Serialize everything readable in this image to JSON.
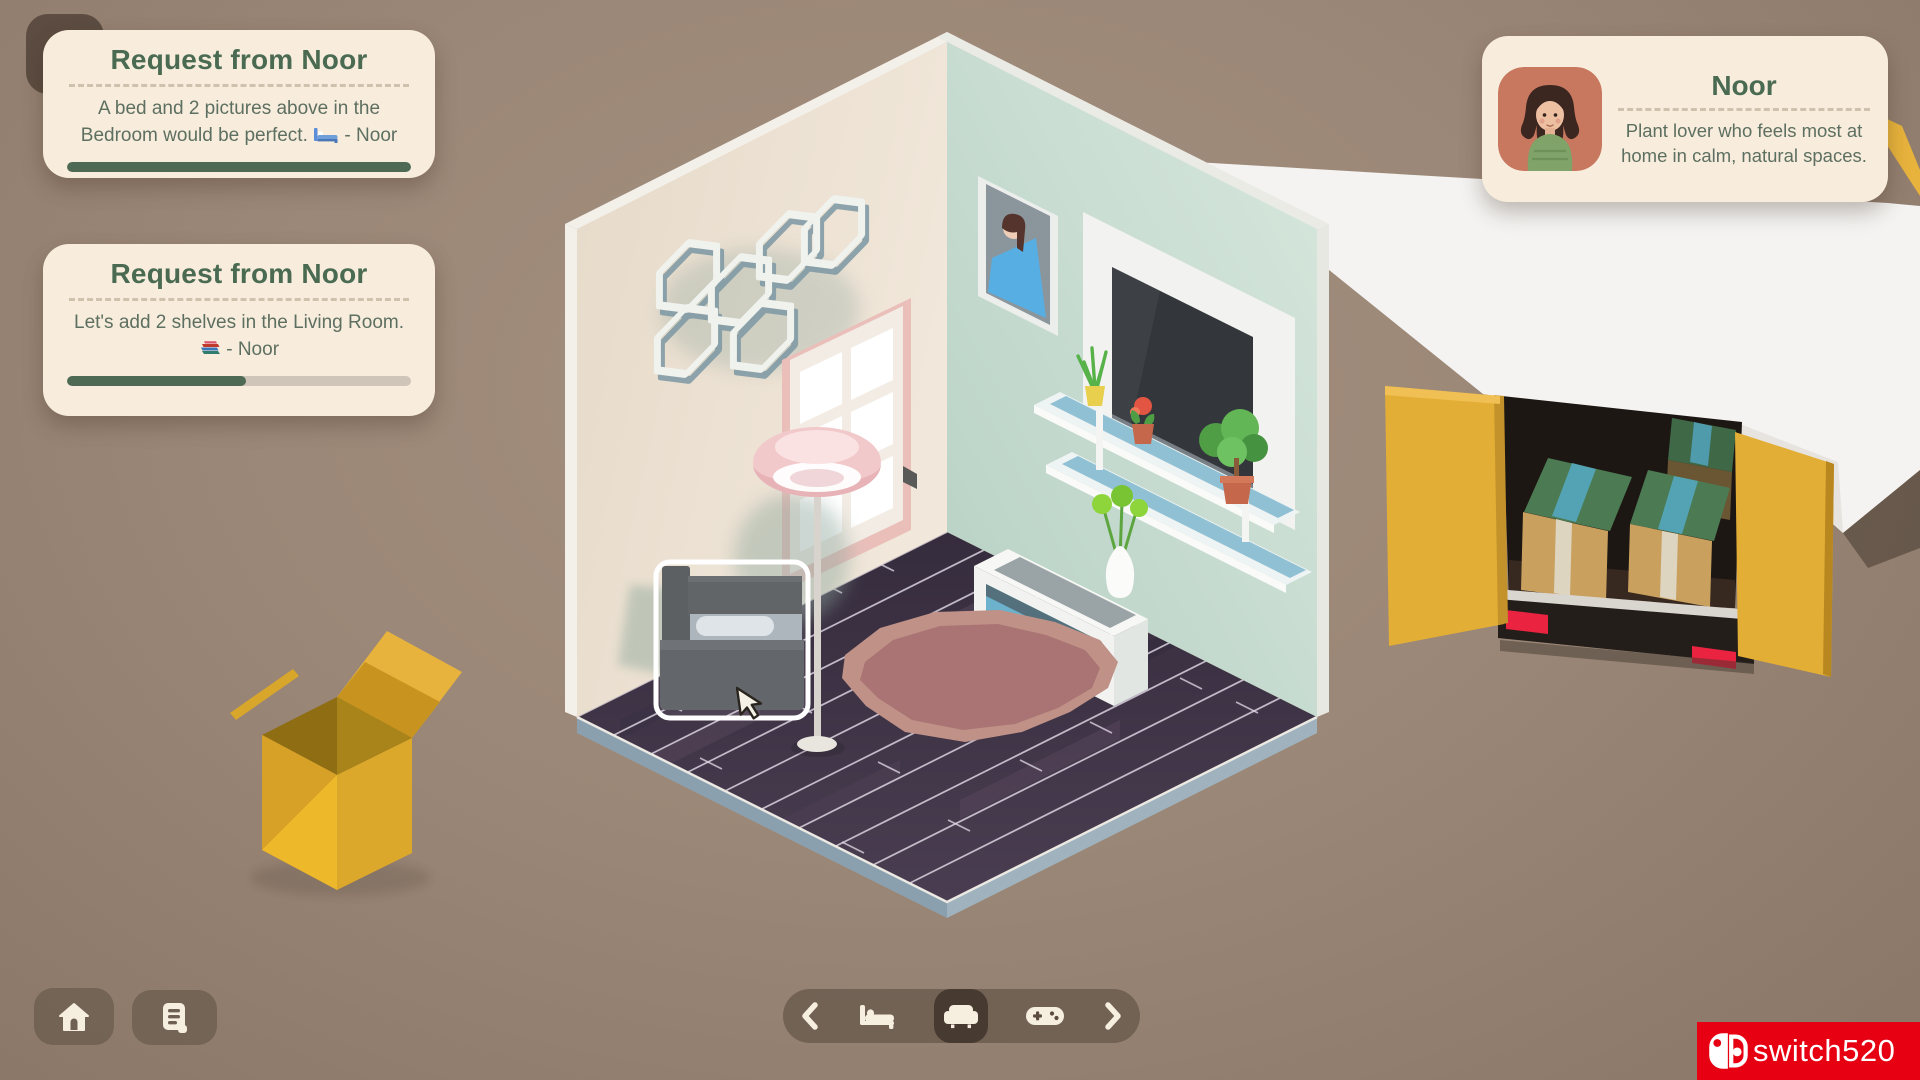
{
  "requests": [
    {
      "title": "Request from Noor",
      "body_main": "A bed and 2 pictures above in the Bedroom would be perfect.",
      "emoji_char": "🛏️",
      "emoji_name": "bed-emoji",
      "body_suffix": "- Noor",
      "progress_percent": "100%"
    },
    {
      "title": "Request from Noor",
      "body_main": "Let's add 2 shelves in the Living Room.",
      "emoji_char": "📚",
      "emoji_name": "books-emoji",
      "body_suffix": "- Noor",
      "progress_percent": "52%"
    }
  ],
  "profile": {
    "name": "Noor",
    "description": "Plant lover who feels most at home in calm, natural spaces."
  },
  "toolbar": {
    "icons": [
      "chevron-left",
      "bed",
      "sofa",
      "gamepad",
      "chevron-right"
    ],
    "selected": "sofa"
  },
  "corner_buttons": [
    "home",
    "log"
  ],
  "watermark": {
    "text": "switch520",
    "color": "#e60012"
  },
  "colors": {
    "background": "#9b8777",
    "card": "#f8eddd",
    "title_green": "#4a6b52",
    "body_green": "#5d6f60",
    "progress_green": "#4e6a55",
    "progress_track": "#cfc5b8",
    "toolbar_pill": "rgba(86,72,61,0.55)",
    "truck_yellow": "#e3ae35",
    "floor_plum": "#413649",
    "left_wall": "#ece1d2",
    "right_wall": "#c6dacf",
    "rug_outer": "#c09186",
    "rug_inner": "#a97473",
    "sofa_gray": "#54585c",
    "avatar_bg": "#c8785f",
    "taillight_red": "#ea2440"
  },
  "scene": {
    "description": "Isometric room with cream left wall (hexagon shelves, pink framed door, pink floor lamp), mint right wall (portrait, wall TV, white shelves with plants, TV stand with vase), plum plank floor, mauve rug, dark gray sofa being placed inside a white selection box with cursor, yellow moving truck with open doors and cardboard boxes at right, open yellow box at lower left."
  }
}
